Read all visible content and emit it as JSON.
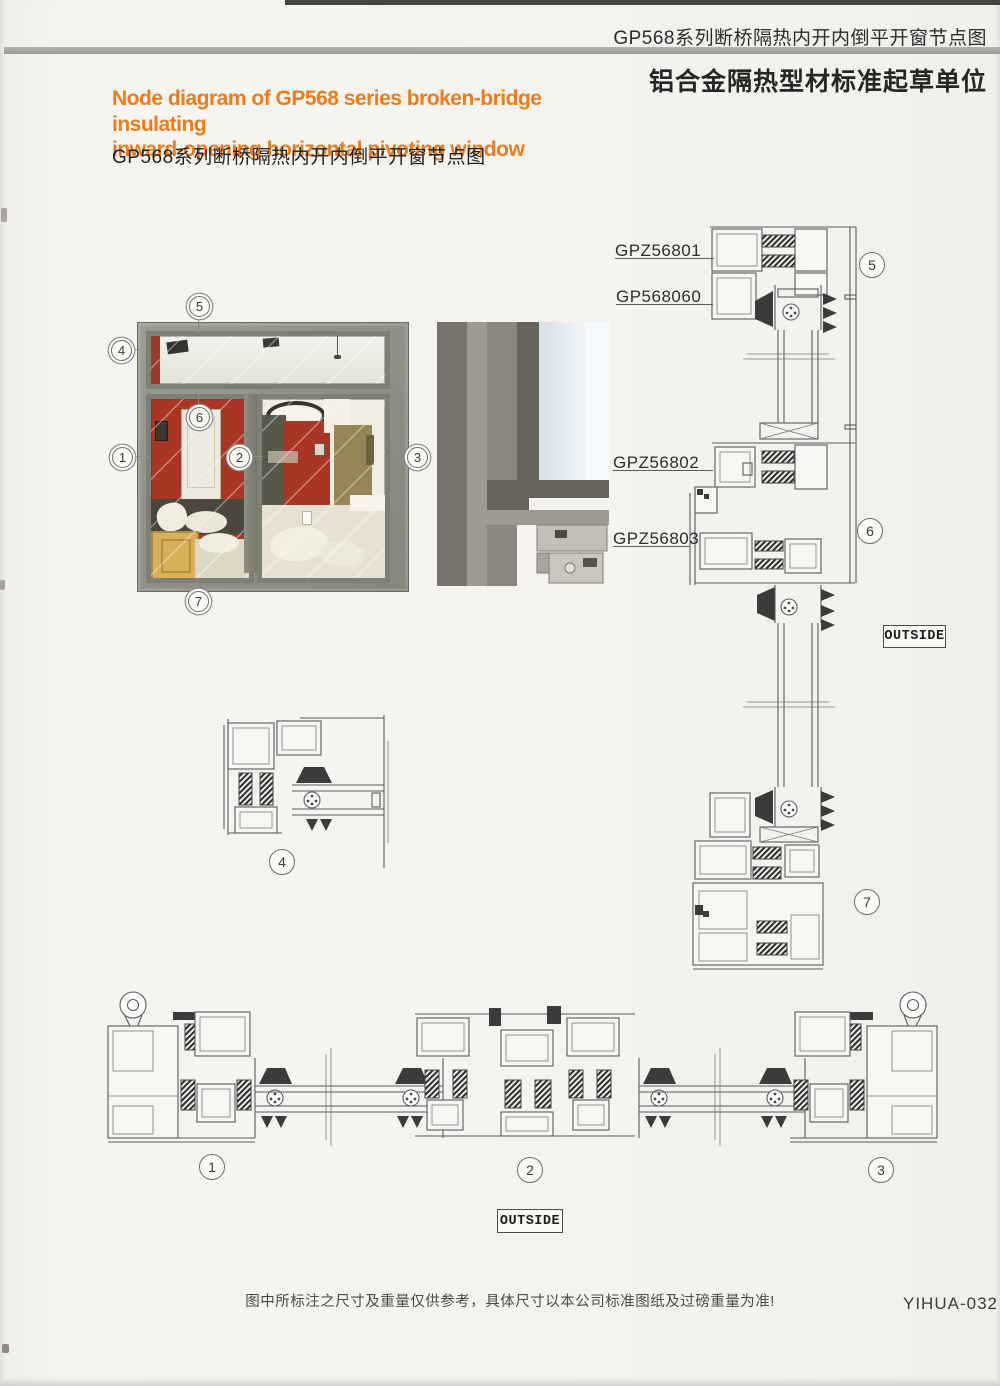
{
  "header": {
    "doc_title": "GP568系列断桥隔热内开内倒平开窗节点图",
    "org_label": "铝合金隔热型材标准起草单位"
  },
  "title": {
    "en_line1": "Node diagram of GP568 series broken-bridge insulating",
    "en_line2": "inward-opening horizontal pivoting window",
    "cn": "GP568系列断桥隔热内开内倒平开窗节点图"
  },
  "part_labels": {
    "head_frame": "GPZ56801",
    "head_sash": "GP568060",
    "transom_upper": "GPZ56802",
    "transom_lower": "GPZ56803"
  },
  "direction_labels": {
    "right_section": "OUTSIDE",
    "bottom_section": "OUTSIDE"
  },
  "callouts": {
    "photo": {
      "c1": "1",
      "c2": "2",
      "c3": "3",
      "c4": "4",
      "c5": "5",
      "c6": "6",
      "c7": "7"
    },
    "section": {
      "c1": "1",
      "c2": "2",
      "c3": "3",
      "c4": "4",
      "c5": "5",
      "c6": "6",
      "c7": "7"
    }
  },
  "footer": {
    "note": "图中所标注之尺寸及重量仅供参考，具体尺寸以本公司标准图纸及过磅重量为准!",
    "page_code": "YIHUA-032"
  },
  "colors": {
    "accent_orange": "#ee7c1a",
    "divider_gray": "#a6a6a4",
    "drawing_line": "#5a5b5e",
    "photo_wall_red": "#a83624"
  }
}
